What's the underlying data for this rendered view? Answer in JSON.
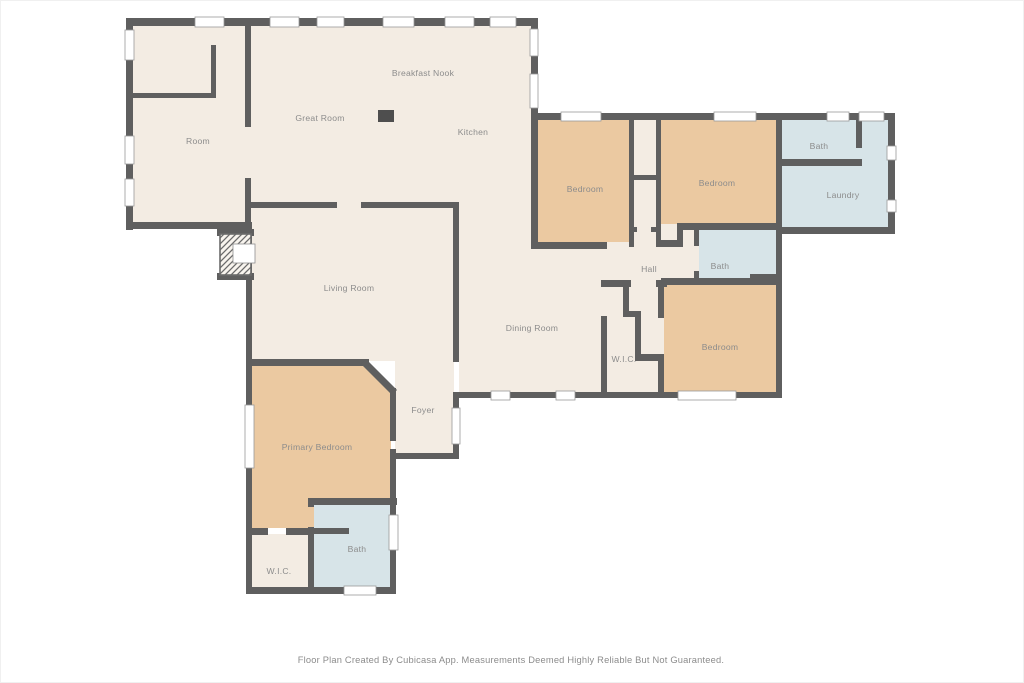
{
  "page": {
    "background": "#ffffff"
  },
  "colors": {
    "floor": "#f3ece3",
    "bedroom_floor": "#ebc9a1",
    "bath_floor": "#d7e4e8",
    "wall": "#5f5f5f",
    "fixture": "#4e4e4e",
    "window_fill": "#ffffff",
    "window_stroke": "#9a9a9a",
    "label_text": "#8c8c8c"
  },
  "rooms": [
    {
      "id": "room",
      "label": "Room"
    },
    {
      "id": "great-room",
      "label": "Great Room"
    },
    {
      "id": "breakfast-nook",
      "label": "Breakfast Nook"
    },
    {
      "id": "kitchen",
      "label": "Kitchen"
    },
    {
      "id": "bedroom-1",
      "label": "Bedroom"
    },
    {
      "id": "bedroom-2",
      "label": "Bedroom"
    },
    {
      "id": "bath-upper",
      "label": "Bath"
    },
    {
      "id": "laundry",
      "label": "Laundry"
    },
    {
      "id": "hall",
      "label": "Hall"
    },
    {
      "id": "bath-middle",
      "label": "Bath"
    },
    {
      "id": "wic-right",
      "label": "W.I.C."
    },
    {
      "id": "bedroom-3",
      "label": "Bedroom"
    },
    {
      "id": "dining-room",
      "label": "Dining Room"
    },
    {
      "id": "living-room",
      "label": "Living Room"
    },
    {
      "id": "foyer",
      "label": "Foyer"
    },
    {
      "id": "primary-bedroom",
      "label": "Primary Bedroom"
    },
    {
      "id": "wic-bottom",
      "label": "W.I.C."
    },
    {
      "id": "bath-bottom",
      "label": "Bath"
    }
  ],
  "footer": {
    "text": "Floor Plan Created By Cubicasa App. Measurements Deemed Highly Reliable But Not Guaranteed."
  }
}
